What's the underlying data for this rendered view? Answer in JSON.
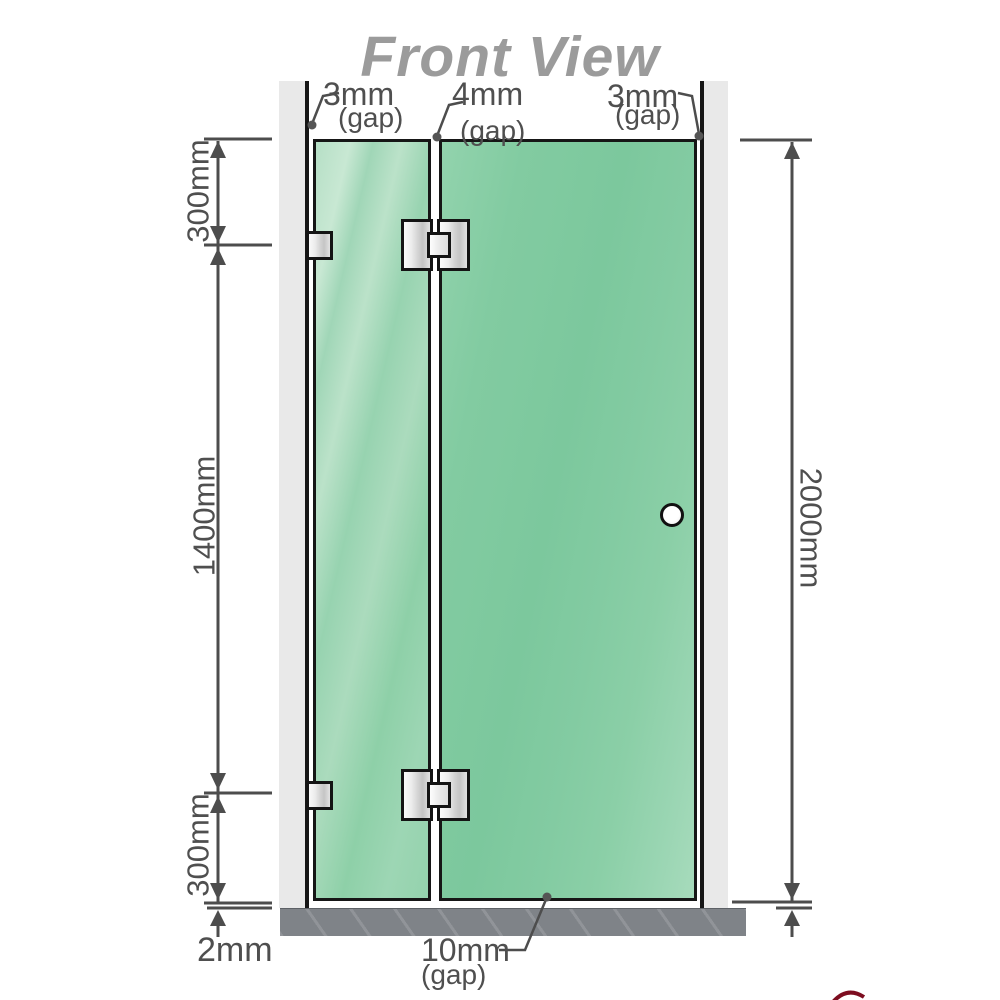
{
  "title": "Front View",
  "dimensions": {
    "top_gaps": [
      {
        "value": "3mm",
        "label": "(gap)"
      },
      {
        "value": "4mm",
        "label": "(gap)"
      },
      {
        "value": "3mm",
        "label": "(gap)"
      }
    ],
    "left_chain": {
      "top": "300mm",
      "middle": "1400mm",
      "bottom": "300mm"
    },
    "right_total": "2000mm",
    "floor_offset": "2mm",
    "bottom_gap": {
      "value": "10mm",
      "label": "(gap)"
    }
  },
  "colors": {
    "glass_fixed_panel": "#9dd5b4",
    "glass_door": "#84cca4",
    "wall": "#e9e9e9",
    "floor": "#7f8388",
    "dimension_lines": "#4d4d4d",
    "title_text": "#9b9b9b",
    "hardware_metal": "#d9d9d9",
    "watermark_mark": "#7d0d20"
  }
}
